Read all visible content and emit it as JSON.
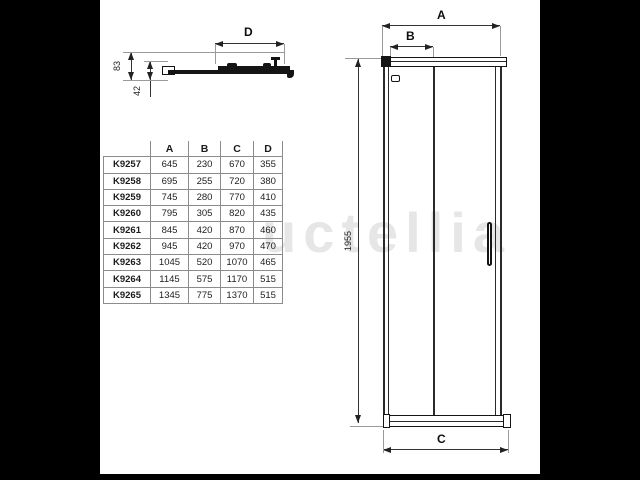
{
  "watermark": {
    "text": "uctellia"
  },
  "detail_view": {
    "d_label": "D",
    "height_83": "83",
    "depth_42": "42"
  },
  "front_view": {
    "a_label": "A",
    "b_label": "B",
    "c_label": "C",
    "height_label": "1955"
  },
  "table": {
    "headers": [
      "",
      "A",
      "B",
      "C",
      "D"
    ],
    "rows": [
      [
        "K9257",
        "645",
        "230",
        "670",
        "355"
      ],
      [
        "K9258",
        "695",
        "255",
        "720",
        "380"
      ],
      [
        "K9259",
        "745",
        "280",
        "770",
        "410"
      ],
      [
        "K9260",
        "795",
        "305",
        "820",
        "435"
      ],
      [
        "K9261",
        "845",
        "420",
        "870",
        "460"
      ],
      [
        "K9262",
        "945",
        "420",
        "970",
        "470"
      ],
      [
        "K9263",
        "1045",
        "520",
        "1070",
        "465"
      ],
      [
        "K9264",
        "1145",
        "575",
        "1170",
        "515"
      ],
      [
        "K9265",
        "1345",
        "775",
        "1370",
        "515"
      ]
    ]
  }
}
